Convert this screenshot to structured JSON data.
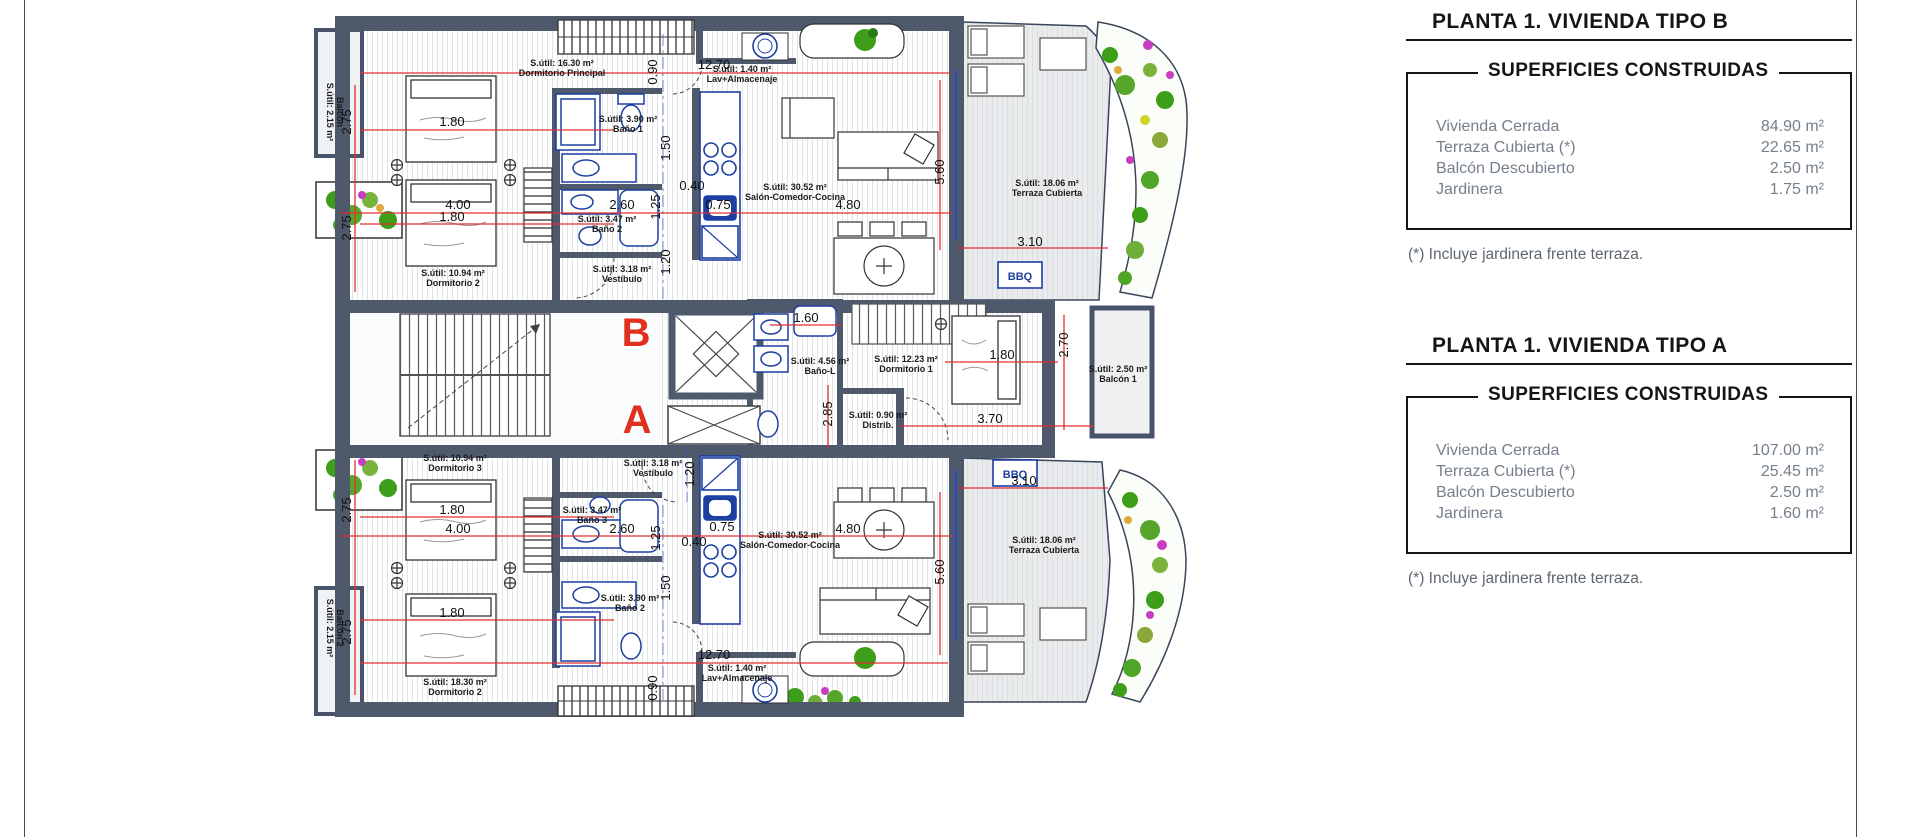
{
  "panels": {
    "b": {
      "title": "PLANTA 1. VIVIENDA TIPO B",
      "header": "SUPERFICIES CONSTRUIDAS",
      "rows": [
        {
          "label": "Vivienda Cerrada",
          "value": "84.90 m²"
        },
        {
          "label": "Terraza Cubierta (*)",
          "value": "22.65 m²"
        },
        {
          "label": "Balcón Descubierto",
          "value": "2.50 m²"
        },
        {
          "label": "Jardinera",
          "value": "1.75 m²"
        }
      ],
      "footnote": "(*) Incluye jardinera frente terraza."
    },
    "a": {
      "title": "PLANTA 1. VIVIENDA TIPO A",
      "header": "SUPERFICIES CONSTRUIDAS",
      "rows": [
        {
          "label": "Vivienda Cerrada",
          "value": "107.00 m²"
        },
        {
          "label": "Terraza Cubierta (*)",
          "value": "25.45 m²"
        },
        {
          "label": "Balcón Descubierto",
          "value": "2.50 m²"
        },
        {
          "label": "Jardinera",
          "value": "1.60 m²"
        }
      ],
      "footnote": "(*) Incluye jardinera frente terraza."
    }
  },
  "plan": {
    "units": [
      {
        "t": "B",
        "x": 636,
        "y": 346
      },
      {
        "t": "A",
        "x": 637,
        "y": 433
      }
    ],
    "bbq": {
      "label": "BBQ",
      "boxes": [
        {
          "x": 998,
          "y": 262
        },
        {
          "x": 993,
          "y": 460
        }
      ]
    },
    "room_labels": [
      {
        "lines": [
          "S.útil: 16.30 m²",
          "Dormitorio Principal"
        ],
        "x": 562,
        "y": 66
      },
      {
        "lines": [
          "S.útil: 1.40 m²",
          "Lav+Almacenaje"
        ],
        "x": 742,
        "y": 72
      },
      {
        "lines": [
          "S.útil: 3.90 m²",
          "Baño 1"
        ],
        "x": 628,
        "y": 122
      },
      {
        "lines": [
          "S.útil: 3.47 m²",
          "Baño 2"
        ],
        "x": 607,
        "y": 222
      },
      {
        "lines": [
          "S.útil: 3.18 m²",
          "Vestíbulo"
        ],
        "x": 622,
        "y": 272
      },
      {
        "lines": [
          "S.útil: 10.94 m²",
          "Dormitorio 2"
        ],
        "x": 453,
        "y": 276
      },
      {
        "lines": [
          "S.útil: 30.52 m²",
          "Salón-Comedor-Cocina"
        ],
        "x": 795,
        "y": 190
      },
      {
        "lines": [
          "S.útil: 18.06 m²",
          "Terraza Cubierta"
        ],
        "x": 1047,
        "y": 186
      },
      {
        "lines": [
          "Balcón",
          "S.útil: 2.15 m²"
        ],
        "x": 337,
        "y": 112,
        "r": 90
      },
      {
        "lines": [
          "S.útil: 4.56 m²",
          "Baño-L"
        ],
        "x": 820,
        "y": 364
      },
      {
        "lines": [
          "S.útil: 12.23 m²",
          "Dormitorio 1"
        ],
        "x": 906,
        "y": 362
      },
      {
        "lines": [
          "S.útil: 0.90 m²",
          "Distrib."
        ],
        "x": 878,
        "y": 418
      },
      {
        "lines": [
          "S.útil: 2.50 m²",
          "Balcón 1"
        ],
        "x": 1118,
        "y": 372
      },
      {
        "lines": [
          "S.útil: 10.94 m²",
          "Dormitorio 3"
        ],
        "x": 455,
        "y": 461
      },
      {
        "lines": [
          "S.útil: 3.18 m²",
          "Vestíbulo"
        ],
        "x": 653,
        "y": 466
      },
      {
        "lines": [
          "S.útil: 3.47 m²",
          "Baño 3"
        ],
        "x": 592,
        "y": 513
      },
      {
        "lines": [
          "S.útil: 3.90 m²",
          "Baño 2"
        ],
        "x": 630,
        "y": 601
      },
      {
        "lines": [
          "S.útil: 30.52 m²",
          "Salón-Comedor-Cocina"
        ],
        "x": 790,
        "y": 538
      },
      {
        "lines": [
          "S.útil: 18.06 m²",
          "Terraza Cubierta"
        ],
        "x": 1044,
        "y": 543
      },
      {
        "lines": [
          "S.útil: 1.40 m²",
          "Lav+Almacenaje"
        ],
        "x": 737,
        "y": 671
      },
      {
        "lines": [
          "S.útil: 18.30 m²",
          "Dormitorio 2"
        ],
        "x": 455,
        "y": 685
      },
      {
        "lines": [
          "Balcón 2",
          "S.útil: 2.15 m²"
        ],
        "x": 337,
        "y": 628,
        "r": 90
      }
    ],
    "dims": [
      {
        "t": "12.70",
        "x": 714,
        "y": 69
      },
      {
        "t": "1.80",
        "x": 452,
        "y": 126
      },
      {
        "t": "4.00",
        "x": 458,
        "y": 209
      },
      {
        "t": "2.60",
        "x": 622,
        "y": 209
      },
      {
        "t": "0.40",
        "x": 692,
        "y": 190
      },
      {
        "t": "0.75",
        "x": 718,
        "y": 209
      },
      {
        "t": "4.80",
        "x": 848,
        "y": 209
      },
      {
        "t": "1.80",
        "x": 452,
        "y": 221
      },
      {
        "t": "3.10",
        "x": 1030,
        "y": 246
      },
      {
        "t": "1.60",
        "x": 806,
        "y": 322
      },
      {
        "t": "1.80",
        "x": 1002,
        "y": 359
      },
      {
        "t": "3.70",
        "x": 990,
        "y": 423
      },
      {
        "t": "3.10",
        "x": 1024,
        "y": 485
      },
      {
        "t": "1.80",
        "x": 452,
        "y": 514
      },
      {
        "t": "4.00",
        "x": 458,
        "y": 533
      },
      {
        "t": "2.60",
        "x": 622,
        "y": 533
      },
      {
        "t": "0.75",
        "x": 722,
        "y": 531
      },
      {
        "t": "0.40",
        "x": 694,
        "y": 546
      },
      {
        "t": "4.80",
        "x": 848,
        "y": 533
      },
      {
        "t": "1.80",
        "x": 452,
        "y": 617
      },
      {
        "t": "12.70",
        "x": 714,
        "y": 659
      },
      {
        "t": "2.75",
        "x": 351,
        "y": 122,
        "r": -90
      },
      {
        "t": "2.75",
        "x": 351,
        "y": 228,
        "r": -90
      },
      {
        "t": "0.90",
        "x": 657,
        "y": 72,
        "r": -90
      },
      {
        "t": "1.50",
        "x": 670,
        "y": 148,
        "r": -90
      },
      {
        "t": "1.25",
        "x": 660,
        "y": 207,
        "r": -90
      },
      {
        "t": "1.20",
        "x": 670,
        "y": 262,
        "r": -90
      },
      {
        "t": "5.60",
        "x": 944,
        "y": 172,
        "r": -90
      },
      {
        "t": "2.70",
        "x": 1068,
        "y": 345,
        "r": -90
      },
      {
        "t": "2.85",
        "x": 832,
        "y": 414,
        "r": -90
      },
      {
        "t": "1.20",
        "x": 694,
        "y": 474,
        "r": -90
      },
      {
        "t": "2.75",
        "x": 351,
        "y": 510,
        "r": -90
      },
      {
        "t": "2.75",
        "x": 351,
        "y": 632,
        "r": -90
      },
      {
        "t": "1.25",
        "x": 660,
        "y": 538,
        "r": -90
      },
      {
        "t": "1.50",
        "x": 670,
        "y": 588,
        "r": -90
      },
      {
        "t": "0.90",
        "x": 657,
        "y": 688,
        "r": -90
      },
      {
        "t": "5.60",
        "x": 944,
        "y": 572,
        "r": -90
      }
    ]
  }
}
